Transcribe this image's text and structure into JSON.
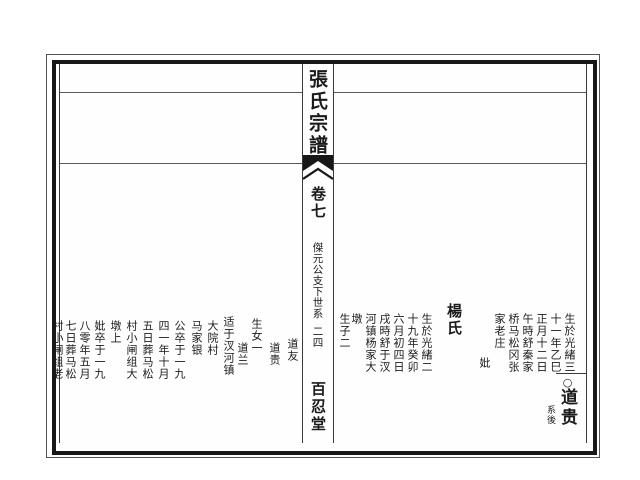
{
  "colors": {
    "ink": "#1b1b1b",
    "paper": "#ffffff"
  },
  "spine": {
    "title": "張氏宗譜",
    "volume": "卷七",
    "section": "傑元公支下世系",
    "page_number": "二四",
    "hall_name": "百忍堂"
  },
  "right_page": {
    "birth_columns": [
      "生於光緒三",
      "十一年乙巳",
      "正月十二日",
      "午時舒秦家",
      "桥马松冈张",
      "家老庄"
    ],
    "mother_label": "妣",
    "mother_name": "楊氏",
    "mother_birth_columns": [
      "生於光緒二",
      "十九年癸卯",
      "六月初四日",
      "戌時舒于汊",
      "河镇杨家大",
      "墩"
    ],
    "sons_note": "生子二",
    "heir_marker": "○",
    "heir_name": "道贵",
    "heir_note": "系後"
  },
  "left_page": {
    "columns": [
      "道友",
      "道贵",
      "生女一",
      "道兰",
      "适于汊河镇",
      "大院村",
      "马家银",
      "公卒于一九",
      "四一年十月",
      "五日葬马松",
      "村小闸组大",
      "墩上",
      "妣卒于一九",
      "八零年五月",
      "七日葬马松",
      "村小闸组老"
    ]
  }
}
